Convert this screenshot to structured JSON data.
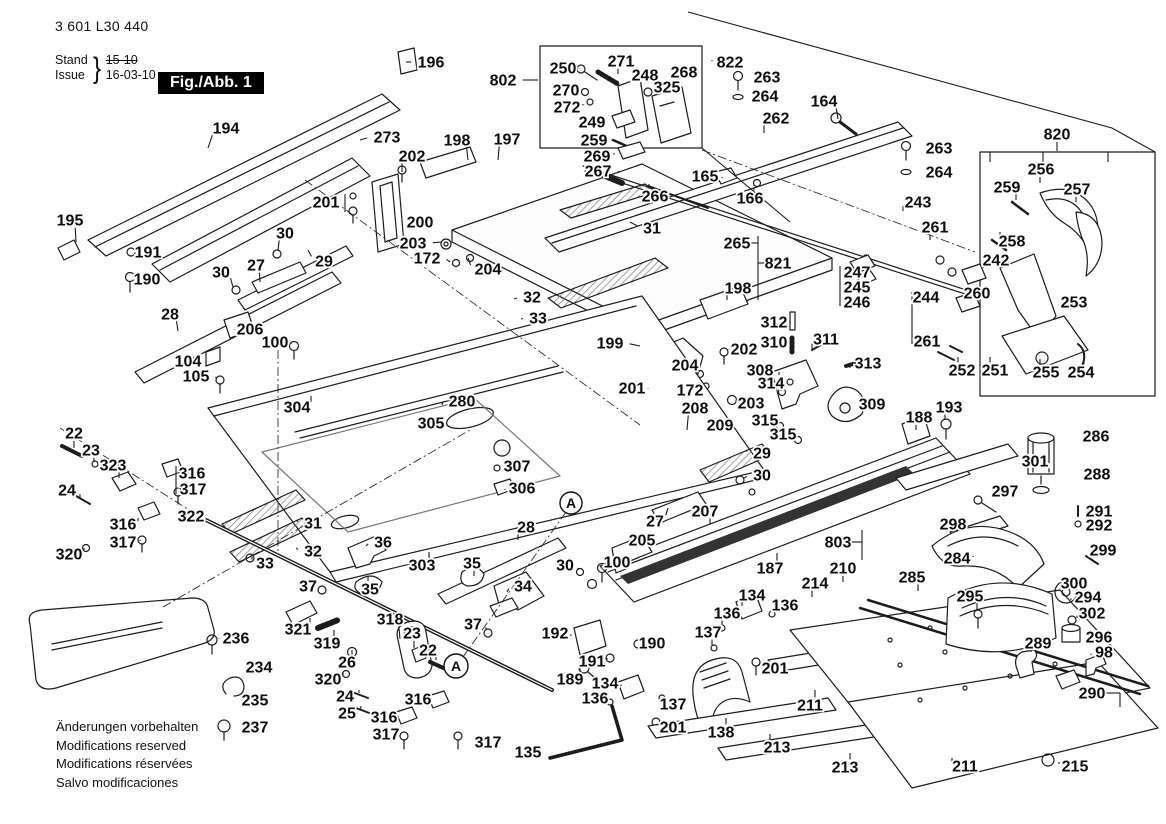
{
  "header": {
    "part_number": "3 601 L30 440",
    "stand_label": "Stand",
    "issue_label": "Issue",
    "brace": "}",
    "stand_value": "15-10",
    "issue_value": "16-03-10",
    "fig_label": "Fig./Abb. 1"
  },
  "footer": {
    "line1": "Änderungen vorbehalten",
    "line2": "Modifications reserved",
    "line3": "Modifications réservées",
    "line4": "Salvo modificaciones"
  },
  "diagram": {
    "detail_markers": [
      {
        "label": "A",
        "x": 571,
        "y": 503,
        "r": 11
      },
      {
        "label": "A",
        "x": 456,
        "y": 666,
        "r": 12
      }
    ],
    "callouts": [
      [
        "194",
        226,
        128,
        208,
        148
      ],
      [
        "196",
        431,
        62,
        406,
        62
      ],
      [
        "273",
        387,
        137,
        360,
        140
      ],
      [
        "202",
        412,
        156,
        402,
        172
      ],
      [
        "198",
        457,
        140,
        468,
        160
      ],
      [
        "197",
        507,
        139,
        498,
        160
      ],
      [
        "802",
        503,
        80,
        538,
        80
      ],
      [
        "201",
        326,
        202,
        342,
        202
      ],
      [
        "200",
        420,
        222,
        402,
        222
      ],
      [
        "203",
        413,
        243,
        442,
        242
      ],
      [
        "172",
        427,
        258,
        450,
        262
      ],
      [
        "204",
        488,
        269,
        468,
        258
      ],
      [
        "29",
        324,
        261,
        308,
        250
      ],
      [
        "195",
        70,
        220,
        76,
        242
      ],
      [
        "191",
        148,
        252,
        132,
        252
      ],
      [
        "190",
        147,
        279,
        130,
        279
      ],
      [
        "30",
        285,
        233,
        278,
        250
      ],
      [
        "27",
        256,
        265,
        260,
        282
      ],
      [
        "30",
        221,
        272,
        233,
        287
      ],
      [
        "28",
        170,
        314,
        178,
        331
      ],
      [
        "206",
        250,
        329,
        234,
        330
      ],
      [
        "100",
        275,
        342,
        291,
        344
      ],
      [
        "104",
        188,
        361,
        208,
        361
      ],
      [
        "105",
        196,
        376,
        216,
        378
      ],
      [
        "304",
        297,
        407,
        311,
        396
      ],
      [
        "305",
        431,
        423,
        417,
        423
      ],
      [
        "280",
        462,
        401,
        442,
        405
      ],
      [
        "32",
        532,
        297,
        514,
        299
      ],
      [
        "33",
        538,
        318,
        521,
        319
      ],
      [
        "199",
        610,
        343,
        640,
        346
      ],
      [
        "31",
        652,
        228,
        630,
        222
      ],
      [
        "266",
        655,
        196,
        649,
        184
      ],
      [
        "267",
        598,
        171,
        620,
        172
      ],
      [
        "165",
        705,
        176,
        722,
        178
      ],
      [
        "166",
        750,
        198,
        754,
        188
      ],
      [
        "265",
        737,
        243,
        754,
        243
      ],
      [
        "821",
        778,
        263,
        762,
        263
      ],
      [
        "198",
        738,
        288,
        727,
        300
      ],
      [
        "262",
        776,
        118,
        764,
        133
      ],
      [
        "164",
        824,
        101,
        838,
        119
      ],
      [
        "822",
        730,
        62,
        712,
        60
      ],
      [
        "263",
        767,
        77,
        749,
        77
      ],
      [
        "264",
        765,
        96,
        747,
        96
      ],
      [
        "250",
        563,
        68,
        579,
        69
      ],
      [
        "271",
        621,
        61,
        618,
        74
      ],
      [
        "248",
        645,
        75,
        641,
        87
      ],
      [
        "268",
        684,
        72,
        679,
        86
      ],
      [
        "325",
        667,
        87,
        653,
        90
      ],
      [
        "270",
        566,
        90,
        581,
        90
      ],
      [
        "272",
        567,
        107,
        583,
        104
      ],
      [
        "249",
        592,
        122,
        609,
        122
      ],
      [
        "259",
        594,
        140,
        612,
        141
      ],
      [
        "269",
        597,
        156,
        614,
        153
      ],
      [
        "820",
        1057,
        134,
        1057,
        151
      ],
      [
        "263",
        939,
        148,
        921,
        148
      ],
      [
        "264",
        939,
        172,
        921,
        172
      ],
      [
        "243",
        918,
        202,
        903,
        211
      ],
      [
        "261",
        935,
        227,
        930,
        240
      ],
      [
        "256",
        1041,
        169,
        1040,
        183
      ],
      [
        "259",
        1007,
        187,
        1016,
        200
      ],
      [
        "257",
        1077,
        189,
        1076,
        202
      ],
      [
        "258",
        1012,
        241,
        1000,
        232
      ],
      [
        "242",
        996,
        260,
        983,
        268
      ],
      [
        "260",
        977,
        293,
        961,
        293
      ],
      [
        "253",
        1074,
        302,
        1091,
        302
      ],
      [
        "252",
        962,
        370,
        958,
        357
      ],
      [
        "251",
        995,
        370,
        990,
        357
      ],
      [
        "255",
        1046,
        372,
        1040,
        359
      ],
      [
        "254",
        1081,
        372,
        1084,
        359
      ],
      [
        "247",
        857,
        272,
        842,
        272
      ],
      [
        "245",
        857,
        287,
        842,
        287
      ],
      [
        "246",
        857,
        302,
        842,
        302
      ],
      [
        "244",
        926,
        297,
        913,
        297
      ],
      [
        "261",
        927,
        341,
        913,
        341
      ],
      [
        "312",
        774,
        322,
        791,
        322
      ],
      [
        "310",
        774,
        342,
        791,
        342
      ],
      [
        "311",
        826,
        339,
        812,
        349
      ],
      [
        "308",
        760,
        370,
        779,
        375
      ],
      [
        "313",
        868,
        363,
        850,
        368
      ],
      [
        "314",
        771,
        383,
        781,
        391
      ],
      [
        "202",
        744,
        349,
        729,
        350
      ],
      [
        "203",
        751,
        403,
        736,
        400
      ],
      [
        "204",
        685,
        365,
        699,
        372
      ],
      [
        "201",
        632,
        388,
        648,
        389
      ],
      [
        "172",
        690,
        390,
        703,
        385
      ],
      [
        "208",
        695,
        408,
        687,
        430
      ],
      [
        "209",
        720,
        425,
        706,
        432
      ],
      [
        "309",
        872,
        404,
        853,
        404
      ],
      [
        "315",
        765,
        420,
        779,
        424
      ],
      [
        "315",
        783,
        434,
        797,
        437
      ],
      [
        "188",
        919,
        417,
        916,
        430
      ],
      [
        "193",
        949,
        407,
        945,
        420
      ],
      [
        "29",
        762,
        453,
        746,
        450
      ],
      [
        "30",
        762,
        475,
        744,
        478
      ],
      [
        "27",
        655,
        521,
        668,
        508
      ],
      [
        "207",
        705,
        511,
        710,
        524
      ],
      [
        "205",
        642,
        540,
        624,
        540
      ],
      [
        "100",
        617,
        562,
        602,
        564
      ],
      [
        "30",
        565,
        565,
        578,
        570
      ],
      [
        "28",
        526,
        527,
        518,
        540
      ],
      [
        "307",
        517,
        466,
        500,
        467
      ],
      [
        "306",
        522,
        488,
        505,
        490
      ],
      [
        "22",
        74,
        433,
        74,
        448
      ],
      [
        "23",
        91,
        450,
        94,
        462
      ],
      [
        "323",
        113,
        465,
        119,
        478
      ],
      [
        "316",
        192,
        473,
        175,
        473
      ],
      [
        "317",
        193,
        489,
        177,
        489
      ],
      [
        "24",
        67,
        490,
        80,
        498
      ],
      [
        "316",
        123,
        524,
        138,
        518
      ],
      [
        "317",
        123,
        542,
        140,
        540
      ],
      [
        "320",
        69,
        554,
        84,
        548
      ],
      [
        "322",
        191,
        516,
        204,
        521
      ],
      [
        "31",
        313,
        523,
        296,
        520
      ],
      [
        "32",
        313,
        551,
        296,
        548
      ],
      [
        "33",
        265,
        563,
        252,
        557
      ],
      [
        "36",
        383,
        542,
        366,
        546
      ],
      [
        "35",
        370,
        589,
        368,
        576
      ],
      [
        "37",
        308,
        586,
        321,
        587
      ],
      [
        "303",
        422,
        565,
        429,
        552
      ],
      [
        "35",
        472,
        563,
        474,
        576
      ],
      [
        "34",
        523,
        586,
        507,
        592
      ],
      [
        "37",
        473,
        624,
        486,
        630
      ],
      [
        "318",
        390,
        619,
        400,
        639
      ],
      [
        "23",
        412,
        633,
        414,
        648
      ],
      [
        "22",
        428,
        650,
        436,
        660
      ],
      [
        "321",
        298,
        629,
        310,
        618
      ],
      [
        "319",
        327,
        643,
        334,
        630
      ],
      [
        "26",
        347,
        662,
        352,
        650
      ],
      [
        "320",
        328,
        679,
        343,
        672
      ],
      [
        "24",
        345,
        696,
        359,
        690
      ],
      [
        "25",
        347,
        713,
        361,
        706
      ],
      [
        "316",
        418,
        699,
        431,
        702
      ],
      [
        "316",
        384,
        717,
        398,
        718
      ],
      [
        "317",
        386,
        734,
        400,
        736
      ],
      [
        "317",
        488,
        742,
        474,
        740
      ],
      [
        "236",
        236,
        638,
        219,
        639
      ],
      [
        "234",
        259,
        667,
        241,
        667
      ],
      [
        "235",
        255,
        700,
        237,
        700
      ],
      [
        "237",
        255,
        727,
        237,
        727
      ],
      [
        "192",
        555,
        633,
        571,
        636
      ],
      [
        "190",
        652,
        643,
        637,
        643
      ],
      [
        "191",
        592,
        661,
        607,
        658
      ],
      [
        "189",
        570,
        679,
        580,
        668
      ],
      [
        "134",
        752,
        595,
        742,
        606
      ],
      [
        "136",
        785,
        605,
        772,
        612
      ],
      [
        "136",
        727,
        613,
        722,
        626
      ],
      [
        "137",
        708,
        632,
        712,
        645
      ],
      [
        "134",
        605,
        683,
        621,
        686
      ],
      [
        "136",
        595,
        698,
        611,
        700
      ],
      [
        "137",
        673,
        704,
        662,
        700
      ],
      [
        "201",
        673,
        727,
        658,
        724
      ],
      [
        "201",
        775,
        668,
        759,
        664
      ],
      [
        "138",
        721,
        732,
        726,
        718
      ],
      [
        "135",
        528,
        752,
        547,
        752
      ],
      [
        "211",
        810,
        705,
        815,
        690
      ],
      [
        "213",
        777,
        747,
        770,
        734
      ],
      [
        "213",
        845,
        767,
        850,
        753
      ],
      [
        "211",
        965,
        766,
        952,
        758
      ],
      [
        "215",
        1075,
        766,
        1059,
        762
      ],
      [
        "187",
        770,
        568,
        777,
        553
      ],
      [
        "803",
        838,
        542,
        857,
        542
      ],
      [
        "210",
        843,
        568,
        843,
        582
      ],
      [
        "214",
        815,
        583,
        812,
        597
      ],
      [
        "285",
        912,
        577,
        918,
        591
      ],
      [
        "295",
        970,
        596,
        977,
        611
      ],
      [
        "284",
        957,
        558,
        973,
        556
      ],
      [
        "298",
        953,
        524,
        969,
        524
      ],
      [
        "297",
        1005,
        491,
        991,
        497
      ],
      [
        "301",
        1035,
        461,
        1019,
        461
      ],
      [
        "286",
        1096,
        436,
        1081,
        436
      ],
      [
        "288",
        1097,
        474,
        1081,
        474
      ],
      [
        "291",
        1099,
        511,
        1085,
        511
      ],
      [
        "292",
        1099,
        525,
        1085,
        525
      ],
      [
        "299",
        1103,
        550,
        1091,
        556
      ],
      [
        "300",
        1074,
        583,
        1061,
        589
      ],
      [
        "294",
        1088,
        597,
        1071,
        600
      ],
      [
        "302",
        1092,
        613,
        1077,
        618
      ],
      [
        "296",
        1099,
        637,
        1085,
        637
      ],
      [
        "289",
        1038,
        643,
        1031,
        652
      ],
      [
        "98",
        1104,
        652,
        1091,
        655
      ],
      [
        "290",
        1092,
        693,
        1079,
        688
      ]
    ],
    "extra_lines": [
      [
        758,
        236,
        758,
        300,
        0
      ],
      [
        758,
        243,
        750,
        243,
        0
      ],
      [
        758,
        263,
        766,
        263,
        0
      ],
      [
        912,
        292,
        912,
        344,
        0
      ],
      [
        345,
        194,
        345,
        212,
        0
      ],
      [
        840,
        266,
        840,
        306,
        0
      ],
      [
        862,
        530,
        862,
        560,
        0
      ],
      [
        850,
        542,
        862,
        542,
        0
      ],
      [
        1106,
        693,
        1120,
        693,
        0
      ],
      [
        1120,
        693,
        1120,
        707,
        0
      ],
      [
        176,
        466,
        176,
        494,
        0
      ],
      [
        702,
        148,
        790,
        222,
        0
      ],
      [
        688,
        12,
        1112,
        128,
        0
      ],
      [
        1112,
        128,
        1155,
        152,
        0
      ],
      [
        990,
        152,
        990,
        162,
        0
      ],
      [
        1043,
        152,
        1043,
        162,
        0
      ],
      [
        1108,
        152,
        1108,
        162,
        0
      ],
      [
        305,
        180,
        640,
        425,
        1
      ],
      [
        163,
        607,
        470,
        430,
        1
      ],
      [
        566,
        512,
        463,
        657,
        1
      ],
      [
        278,
        350,
        278,
        552,
        1
      ],
      [
        60,
        428,
        205,
        520,
        1
      ],
      [
        702,
        150,
        975,
        252,
        1
      ]
    ]
  }
}
